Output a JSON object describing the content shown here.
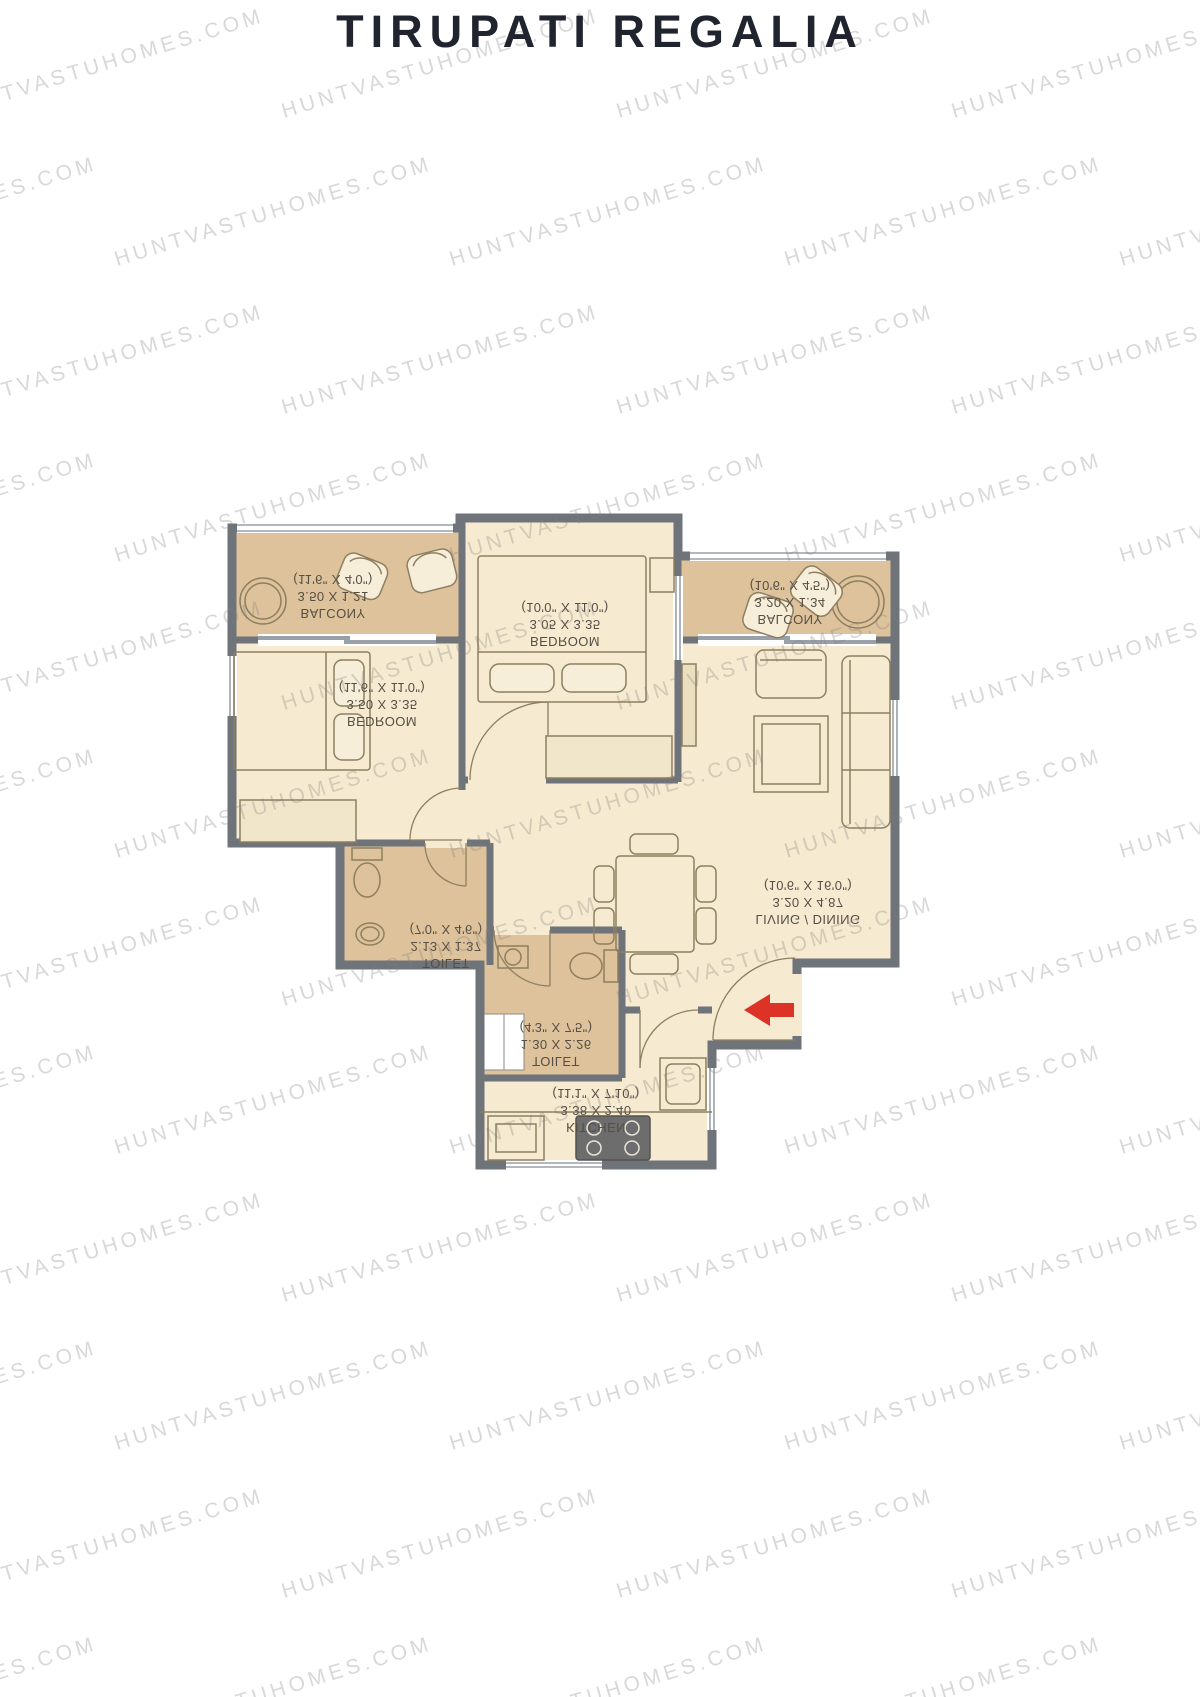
{
  "title": "TIRUPATI REGALIA",
  "watermark": {
    "text": "HUNTVASTUHOMES.COM"
  },
  "plan": {
    "colors": {
      "wall": "#6f737a",
      "floor": "#f6ead0",
      "wet_area": "#ddc29b",
      "furniture_line": "#8d7f60",
      "label_text": "#564f45",
      "entry_arrow_red": "#dd3226"
    },
    "note": "room label text is displayed vertically flipped in source image",
    "rooms": [
      {
        "id": "balcony-1",
        "name": "BALCONY",
        "metric": "3.50 X 1.21",
        "imperial": "(11'6\" X 4'0\")"
      },
      {
        "id": "bedroom-1",
        "name": "BEDROOM",
        "metric": "3.50 X 3.35",
        "imperial": "(11'6\" X 11'0\")"
      },
      {
        "id": "bedroom-2",
        "name": "BEDROOM",
        "metric": "3.05 X 3.35",
        "imperial": "(10'0\" X 11'0\")"
      },
      {
        "id": "balcony-2",
        "name": "BALCONY",
        "metric": "3.20 X 1.34",
        "imperial": "(10'6\" X 4'5\")"
      },
      {
        "id": "living-dining",
        "name": "LIVING / DINING",
        "metric": "3.20 X 4.87",
        "imperial": "(10'6\" X 16'0\")"
      },
      {
        "id": "toilet-1",
        "name": "TOILET",
        "metric": "2.13 X 1.37",
        "imperial": "(7'0\" X 4'6\")"
      },
      {
        "id": "toilet-2",
        "name": "TOILET",
        "metric": "1.30 X 2.26",
        "imperial": "(4'3\" X 7'5\")"
      },
      {
        "id": "kitchen",
        "name": "KITCHEN",
        "metric": "3.38 X 2.40",
        "imperial": "(11'1\" X 7'10\")"
      }
    ]
  }
}
